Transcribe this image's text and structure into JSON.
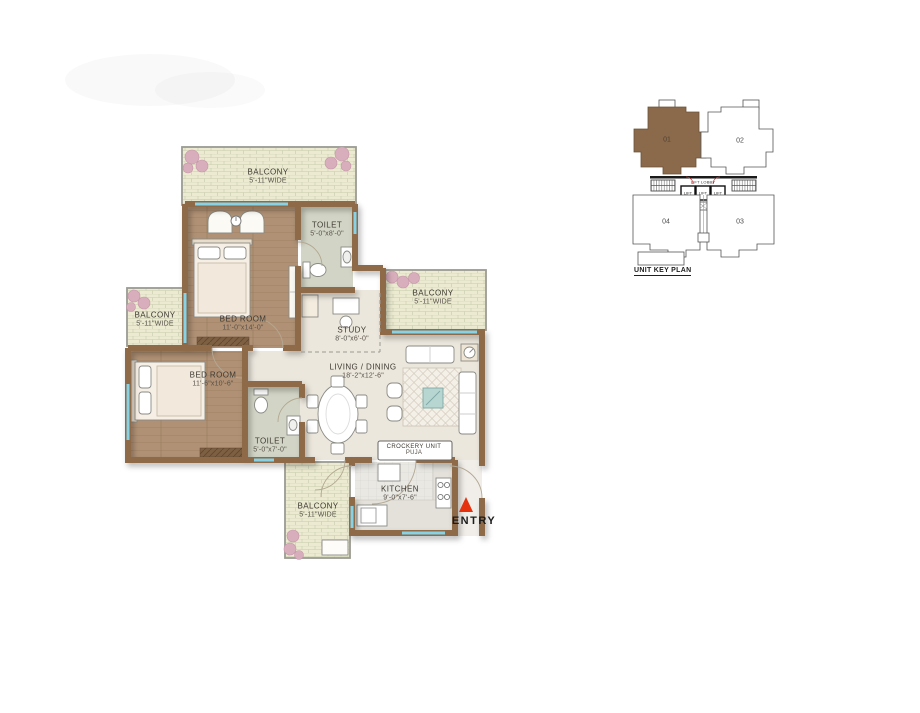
{
  "floor_plan": {
    "rooms": {
      "balcony_top": {
        "label": "BALCONY",
        "dim": "5'-11\"WIDE"
      },
      "bedroom_top": {
        "label": "BED ROOM",
        "dim": "11'-0\"x14'-0\""
      },
      "toilet_top": {
        "label": "TOILET",
        "dim": "5'-0\"x8'-0\""
      },
      "study": {
        "label": "STUDY",
        "dim": "8'-0\"x6'-0\""
      },
      "balcony_right": {
        "label": "BALCONY",
        "dim": "5'-11\"WIDE"
      },
      "balcony_left": {
        "label": "BALCONY",
        "dim": "5'-11\"WIDE"
      },
      "bedroom_bottom": {
        "label": "BED ROOM",
        "dim": "11'-6\"x10'-6\""
      },
      "toilet_bottom": {
        "label": "TOILET",
        "dim": "5'-0\"x7'-0\""
      },
      "living": {
        "label": "LIVING / DINING",
        "dim": "18'-2\"x12'-6\""
      },
      "crockery": {
        "label": "CROCKERY UNIT",
        "dim": "PUJA"
      },
      "kitchen": {
        "label": "KITCHEN",
        "dim": "9'-0\"x7'-6\""
      },
      "balcony_bottom": {
        "label": "BALCONY",
        "dim": "5'-11\"WIDE"
      }
    },
    "entry_label": "ENTRY"
  },
  "unit_key_plan": {
    "title": "UNIT KEY PLAN",
    "lift_lobby_label": "LIFT LOBBY",
    "lift_label": "LIFT",
    "units": {
      "u01": {
        "number": "01",
        "highlighted": true
      },
      "u02": {
        "number": "02",
        "highlighted": false
      },
      "u03": {
        "number": "03",
        "highlighted": false
      },
      "u04": {
        "number": "04",
        "highlighted": false
      }
    }
  },
  "colors": {
    "wall": "#8e6b49",
    "highlighted_unit": "#8b6a4c",
    "entry_arrow": "#e5310e",
    "window_glazing": "#86d2e6"
  }
}
